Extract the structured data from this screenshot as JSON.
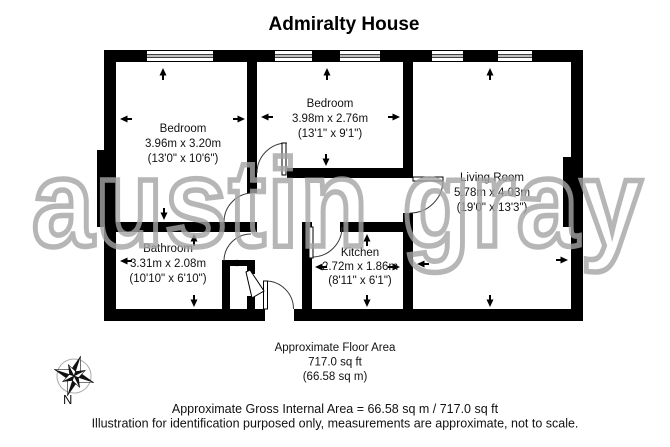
{
  "title": "Admiralty House",
  "watermark": "austin gray",
  "rooms": [
    {
      "name": "Bedroom",
      "metric": "3.96m x 3.20m",
      "imperial": "(13'0\" x 10'6\")"
    },
    {
      "name": "Bedroom",
      "metric": "3.98m x 2.76m",
      "imperial": "(13'1\" x 9'1\")"
    },
    {
      "name": "Living Room",
      "metric": "5.78m x 4.03m",
      "imperial": "(19'0\" x 13'3\")"
    },
    {
      "name": "Bathroom",
      "metric": "3.31m x 2.08m",
      "imperial": "(10'10\" x 6'10\")"
    },
    {
      "name": "Kitchen",
      "metric": "2.72m x 1.86m",
      "imperial": "(8'11\" x 6'1\")"
    }
  ],
  "floor_area": {
    "line1": "Approximate Floor Area",
    "line2": "717.0 sq ft",
    "line3": "(66.58 sq m)"
  },
  "footer": {
    "gross_area": "Approximate Gross Internal Area = 66.58 sq m / 717.0 sq ft",
    "disclaimer": "Illustration for identification purposed only, measurements are approximate, not to scale."
  },
  "compass": {
    "label": "N"
  },
  "colors": {
    "wall": "#000000",
    "watermark": "#a5a5a5"
  }
}
